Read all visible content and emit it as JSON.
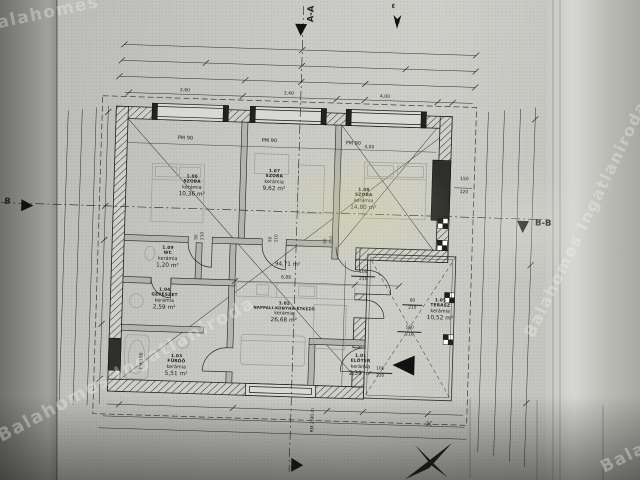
{
  "colors": {
    "paper": "#c3c3bf",
    "paper_dark": "#8b8b87",
    "ink": "#22221f",
    "glare": "#d2d89e",
    "watermark": "#f5f5f0"
  },
  "watermarks": {
    "top_left": "Balahomes",
    "bottom_left": "Balahomes Ingatlaniroda",
    "right": "Balahomes Ingatlaniroda",
    "bottom_right": "Balaho"
  },
  "section_markers": {
    "aa": "A-A",
    "bb_left": "B",
    "bb_right": "B-B",
    "north": "É"
  },
  "rooms": {
    "szoba1": {
      "id": "1.06",
      "name": "SZOBA",
      "material": "kerámia",
      "area": "10,36 m²"
    },
    "szoba2": {
      "id": "1.07",
      "name": "SZOBA",
      "material": "kerámia",
      "area": "9,62 m²"
    },
    "szoba3": {
      "id": "1.08",
      "name": "SZOBA",
      "material": "kerámia",
      "area": "14,80 m²"
    },
    "wc": {
      "id": "1.09",
      "name": "WC",
      "material": "kerámia",
      "area": "1,20 m²"
    },
    "gepeszet": {
      "id": "1.04",
      "name": "GÉPÉSZET",
      "material": "kerámia",
      "area": "2,59 m²"
    },
    "furdo": {
      "id": "1.03",
      "name": "FÜRDŐ",
      "material": "kerámia",
      "area": "5,51 m²"
    },
    "nappali": {
      "id": "1.02",
      "name": "NAPPALI-KONYHA-ÉTKEZŐ",
      "material": "kerámia",
      "area": "26,68 m²"
    },
    "terasz": {
      "id": "1.05",
      "name": "TERASZ",
      "material": "kerámia",
      "area": "10,52 m²"
    },
    "eloter": {
      "id": "1.01",
      "name": "ELŐTÉR",
      "material": "kerámia",
      "area": "2,39 m²"
    }
  },
  "openings": {
    "pm90": "PM 90",
    "pm180": "PM 180",
    "room_height": "RM 2,90 m",
    "door90_w": "90",
    "door90_h": "210",
    "door100_w": "100",
    "door100_h": "210",
    "door80_w": "80",
    "door80_h": "210",
    "window_w": "150",
    "window_h": "120"
  },
  "dimensions": {
    "total_area": "94,71 m²",
    "living_width": "6,86",
    "szoba1_width": "2,60",
    "szoba2_width": "2,40",
    "szoba3_width": "4,00",
    "szoba3_depth": "4,00"
  }
}
